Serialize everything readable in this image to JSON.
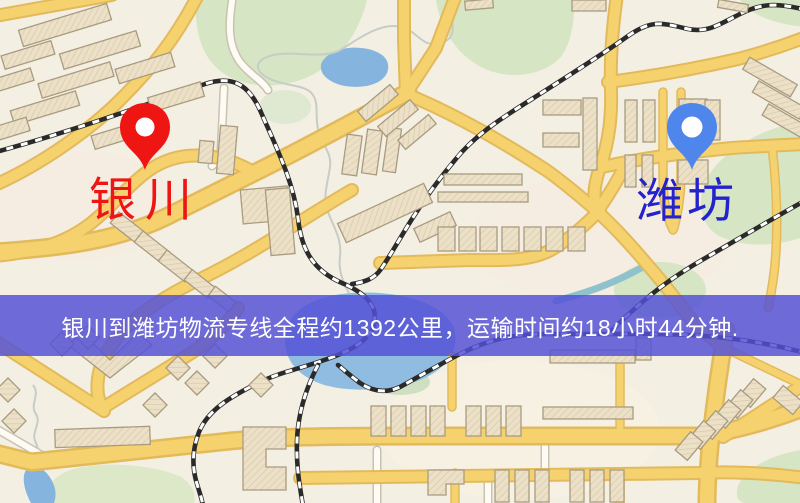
{
  "map": {
    "markers": {
      "origin": {
        "name": "银川",
        "pin_color": "#ee1512",
        "label_color": "#ee1512"
      },
      "destination": {
        "name": "潍坊",
        "pin_color": "#4f86ec",
        "label_color": "#2422cb"
      }
    },
    "banner": {
      "text": "银川到潍坊物流专线全程约1392公里，运输时间约18小时44分钟.",
      "background": "#5451d6",
      "text_color": "#ffffff"
    },
    "palette": {
      "land": "#f4efe3",
      "road": "#f6d26f",
      "road_casing": "#e2ba5c",
      "minor_road": "#fdfbf4",
      "water": "#8fbce0",
      "park": "#d6e5c4",
      "building": "#ece1c8",
      "building_outline": "#a99b80",
      "railway": "#2a2a2a"
    }
  }
}
